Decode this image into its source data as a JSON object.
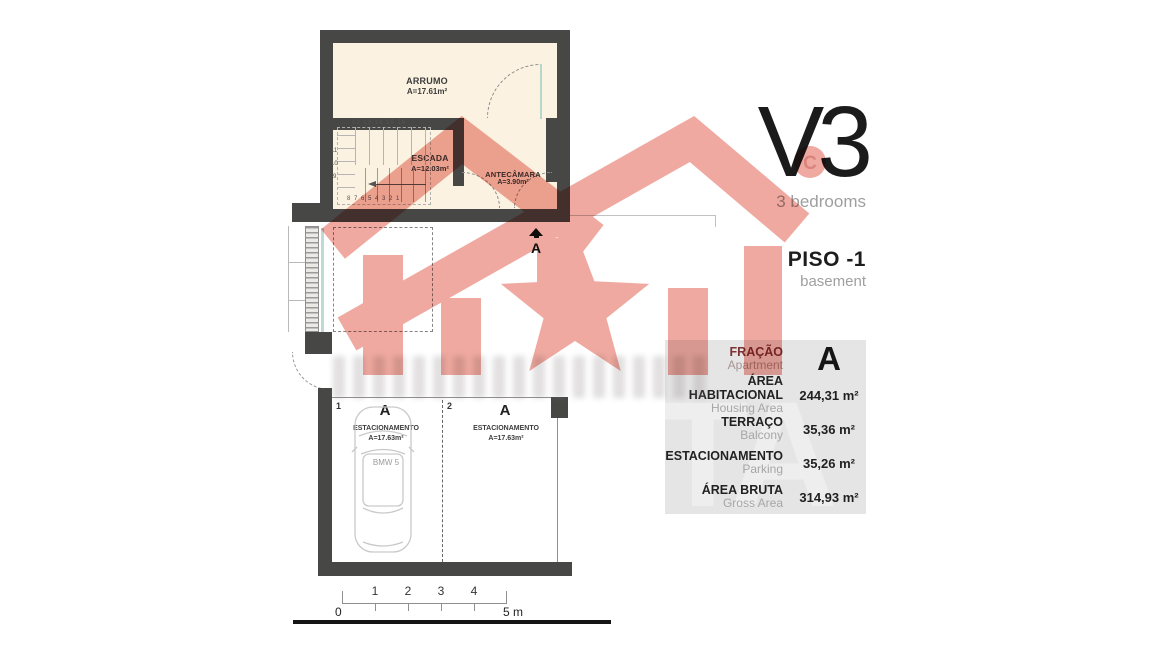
{
  "header": {
    "title": "V3",
    "subtitle": "3 bedrooms",
    "floor": "PISO -1",
    "floor_en": "basement"
  },
  "plan": {
    "upper_unit": {
      "rooms": [
        {
          "name": "ARRUMO",
          "area": "A=17.61m²"
        },
        {
          "name": "ESCADA",
          "area": "A=12.03m²"
        },
        {
          "name": "ANTECÂMARA",
          "area": "A=3.90m²"
        }
      ],
      "stairs": {
        "numbers_top": "12 13 14 15 16",
        "numbers_left": [
          "11",
          "10",
          "9"
        ],
        "numbers_bottom": "8  7  6  5  4  3  2  1"
      }
    },
    "section_marker": "A",
    "garage": {
      "spots": [
        {
          "number": "1",
          "letter": "A",
          "name": "ESTACIONAMENTO",
          "area": "A=17.63m²",
          "car": "BMW 5"
        },
        {
          "number": "2",
          "letter": "A",
          "name": "ESTACIONAMENTO",
          "area": "A=17.63m²"
        }
      ]
    },
    "scale_bar": {
      "ticks_above": [
        "1",
        "2",
        "3",
        "4"
      ],
      "start": "0",
      "end": "5 m"
    }
  },
  "table": {
    "watermark": "TA",
    "rows": [
      {
        "label_pt": "FRAÇÃO",
        "label_en": "Apartment",
        "value": "A"
      },
      {
        "label_pt": "ÁREA HABITACIONAL",
        "label_en": "Housing Area",
        "value": "244,31 m²"
      },
      {
        "label_pt": "TERRAÇO",
        "label_en": "Balcony",
        "value": "35,36 m²"
      },
      {
        "label_pt": "ESTACIONAMENTO",
        "label_en": "Parking",
        "value": "35,26 m²"
      },
      {
        "label_pt": "ÁREA BRUTA",
        "label_en": "Gross Area",
        "value": "314,93 m²"
      }
    ]
  },
  "colors": {
    "watermark_pink": "#f0a9a0",
    "wall": "#474746",
    "room_cream": "#fbf2e1",
    "table_bg": "#e5e5e5",
    "fracao_red": "#7d3333"
  }
}
